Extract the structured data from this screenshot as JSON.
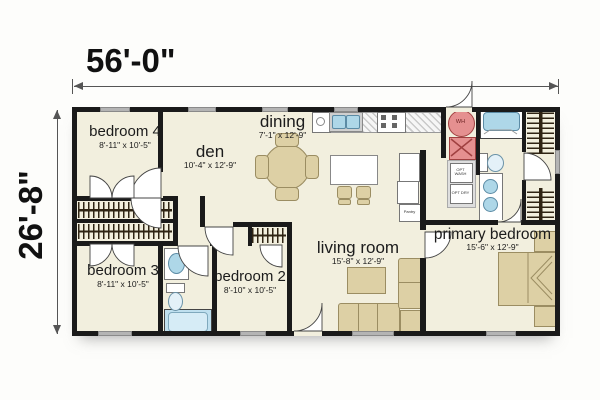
{
  "dimensions": {
    "width_label": "56'-0\"",
    "height_label": "26'-8\""
  },
  "rooms": [
    {
      "name": "bedroom 4",
      "dims": "8'-11\" x 10'-5\""
    },
    {
      "name": "den",
      "dims": "10'-4\" x 12'-9\""
    },
    {
      "name": "dining",
      "dims": "7'-1\" x 12'-9\""
    },
    {
      "name": "living room",
      "dims": "15'-8\" x 12'-9\""
    },
    {
      "name": "primary bedroom",
      "dims": "15'-6\" x 12'-9\""
    },
    {
      "name": "bedroom 3",
      "dims": "8'-11\" x 10'-5\""
    },
    {
      "name": "bedroom 2",
      "dims": "8'-10\" x 10'-5\""
    }
  ],
  "labels": {
    "water_heater": "WH",
    "pantry": "Pantry",
    "opt_washer": "OPT WASH",
    "opt_dryer": "OPT DRY"
  },
  "colors": {
    "wall": "#1a1a1a",
    "floor": "#f2efde",
    "fixture_blue": "#aed7e8",
    "furniture_tan": "#ddd0a5",
    "appliance_red": "#e59090",
    "window_gray": "#b4b4b4"
  }
}
